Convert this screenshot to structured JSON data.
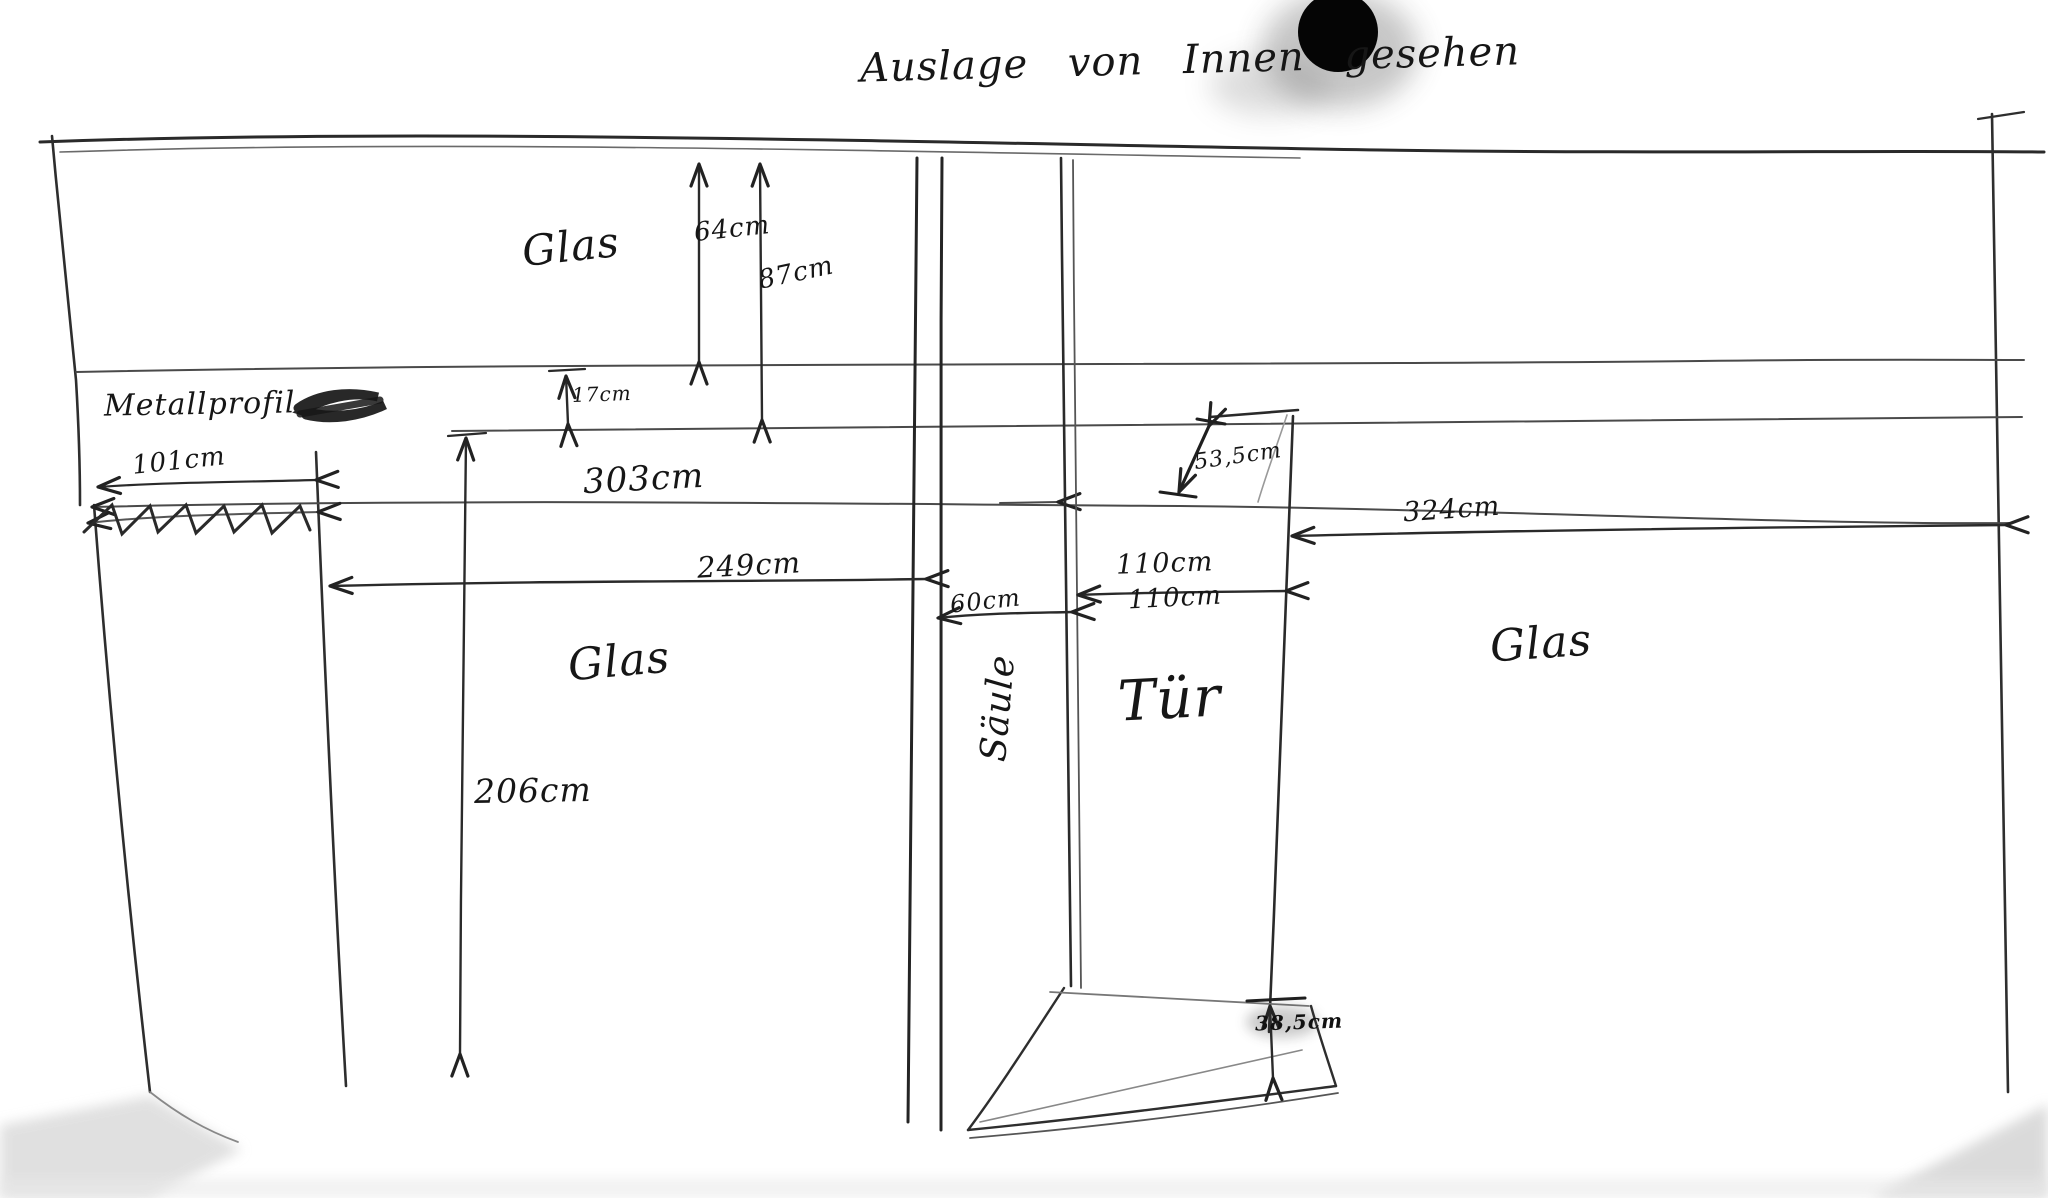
{
  "meta": {
    "title_caption": "Auslage von Innen gesehen",
    "drawing_type": "hand-drawn shopfront sketch, interior view"
  },
  "labels": {
    "glass_top": "Glas",
    "metal_profile": "Metallprofil",
    "glass_left": "Glas",
    "column": "Säule",
    "door": "Tür",
    "glass_right": "Glas"
  },
  "dimensions": {
    "glass_top_height": "64cm",
    "glass_top_total_height": "87cm",
    "profile_gap": "17cm",
    "left_wall_width": "101cm",
    "upper_span": "303cm",
    "door_top_diagonal": "53,5cm",
    "right_glass_width": "324cm",
    "left_glass_width": "249cm",
    "door_width_top": "110cm",
    "door_width_bottom": "110cm",
    "column_width": "60cm",
    "glass_height": "206cm",
    "step_height": "38,5cm"
  },
  "colors": {
    "ink": "#1f1f1f",
    "pencil": "#4a4a4a",
    "paper": "#ffffff",
    "ink_blot": "#050505"
  }
}
